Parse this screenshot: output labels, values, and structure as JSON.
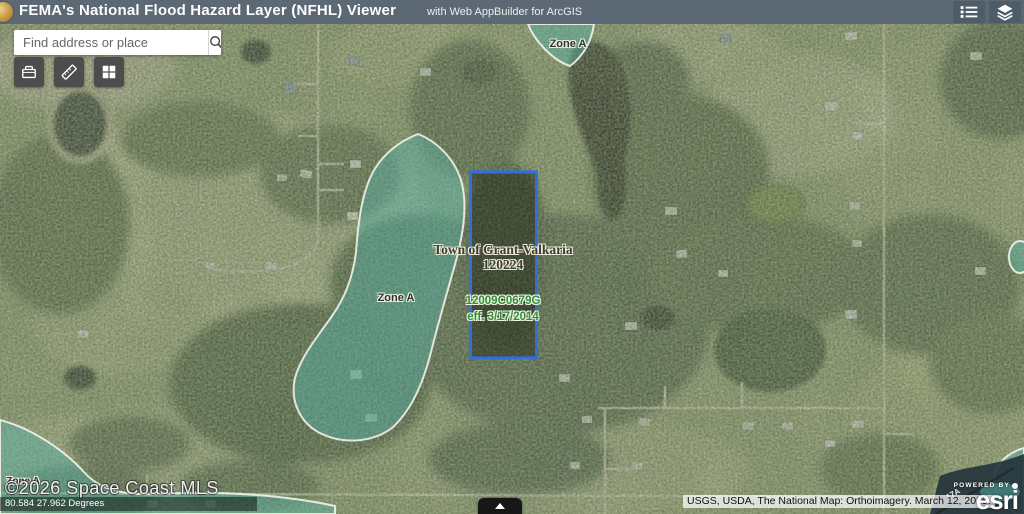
{
  "header": {
    "title": "FEMA's National Flood Hazard Layer (NFHL) Viewer",
    "subtitle": "with Web AppBuilder for ArcGIS",
    "buttons": [
      {
        "name": "legend",
        "icon": "legend-icon"
      },
      {
        "name": "layers",
        "icon": "layers-icon"
      }
    ]
  },
  "search": {
    "placeholder": "Find address or place",
    "icon": "search-icon"
  },
  "toolbar": {
    "buttons": [
      {
        "name": "toolbox",
        "icon": "toolbox-icon"
      },
      {
        "name": "measure",
        "icon": "ruler-icon"
      },
      {
        "name": "basemap-grid",
        "icon": "grid-icon"
      }
    ]
  },
  "map": {
    "flood_zone_labels": {
      "top": "Zone A",
      "west": "Zone A",
      "southwest": "Zone A"
    },
    "parcel": {
      "town_line1": "Town of Grant-Valkaria",
      "town_line2": "120224",
      "firm_panel": "12009C0679G",
      "firm_effective": "eff. 3/17/2014"
    },
    "annotations": {
      "pole_line": "17A"
    },
    "watermark": "©2026 Space Coast MLS",
    "coordinates": "80.584 27.962 Degrees",
    "attribution": "USGS, USDA, The National Map: Orthoimagery. March 12, 2025.",
    "esri": {
      "powered_by": "POWERED BY",
      "brand": "esri"
    },
    "colors": {
      "header_bar": "#5c6974",
      "flood_zone_fill": "#57b3a8",
      "parcel_outline": "#2f6fe0",
      "firm_text_green": "#2f8f3a"
    }
  },
  "footer": {
    "table_toggle_icon": "chevron-up-icon"
  }
}
